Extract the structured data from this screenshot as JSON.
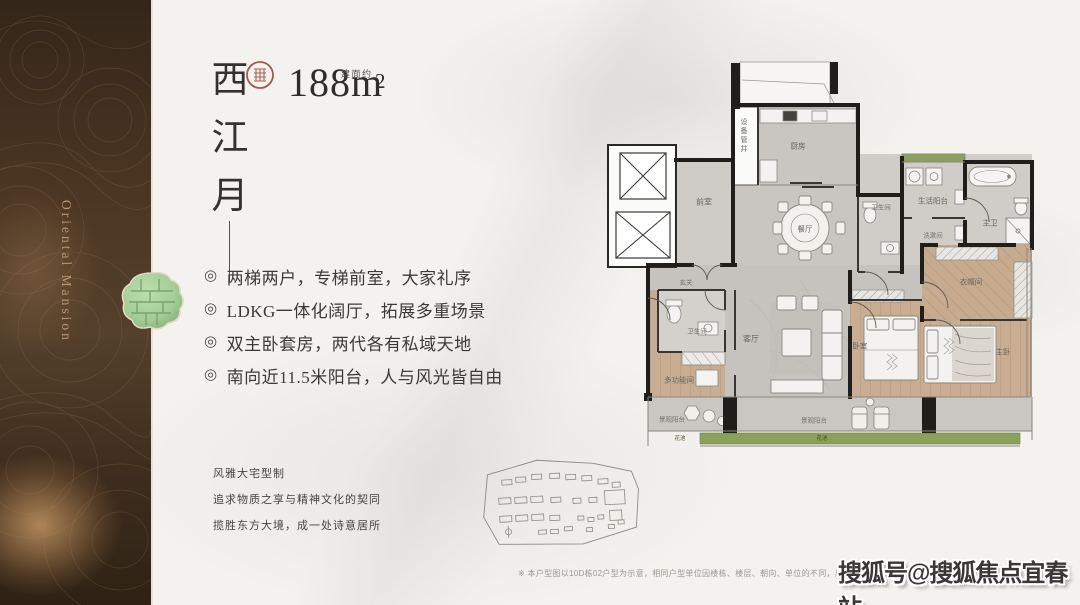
{
  "brand": {
    "vertical_text": "Oriental Mansion"
  },
  "header": {
    "title_chars": [
      "西",
      "江",
      "月"
    ],
    "area_prefix": "建面约",
    "area_value": "188",
    "area_unit": "m",
    "area_sup": "2"
  },
  "highlights": {
    "bullet": "◎",
    "items": [
      "两梯两户，专梯前室，大家礼序",
      "LDKG一体化阔厅，拓展多重场景",
      "双主卧套房，两代各有私域天地",
      "南向近11.5米阳台，人与风光皆自由"
    ]
  },
  "tagline": {
    "lines": [
      "风雅大宅型制",
      "追求物质之享与精神文化的契同",
      "揽胜东方大境，成一处诗意居所"
    ]
  },
  "floorplan": {
    "rooms": {
      "equipment_shaft": "设备管井",
      "kitchen": "厨房",
      "lift_lobby": "前室",
      "dining": "餐厅",
      "bath_small": "卫生间",
      "service_balcony": "生活阳台",
      "laundry": "洗漱间",
      "master_bath": "主卫",
      "foyer": "玄关",
      "guest_bath": "卫生间",
      "multi_room": "多功能间",
      "living": "客厅",
      "bedroom": "卧室",
      "cloak_room": "衣帽间",
      "master_bedroom": "主卧",
      "view_balcony_left": "景观阳台",
      "view_balcony_right": "景观阳台",
      "planter_left": "花池",
      "planter_right": "花池"
    }
  },
  "footer": {
    "disclaimer": "※ 本户型图以10D栋02户型为示意，相同户型单位因楼栋、楼层、朝向、单位的不同，局部结构、面积、数值等可能不同…",
    "watermark": "搜狐号@搜狐焦点宜春站"
  },
  "colors": {
    "sidebar_brown": "#4a3522",
    "brand_gold": "#c39a72",
    "jade_green": "#a3cc96",
    "seal_red": "#a04540",
    "planter_green": "#8aa15c",
    "wood_tan": "#c6ab8f",
    "wall_black": "#201e1b"
  }
}
